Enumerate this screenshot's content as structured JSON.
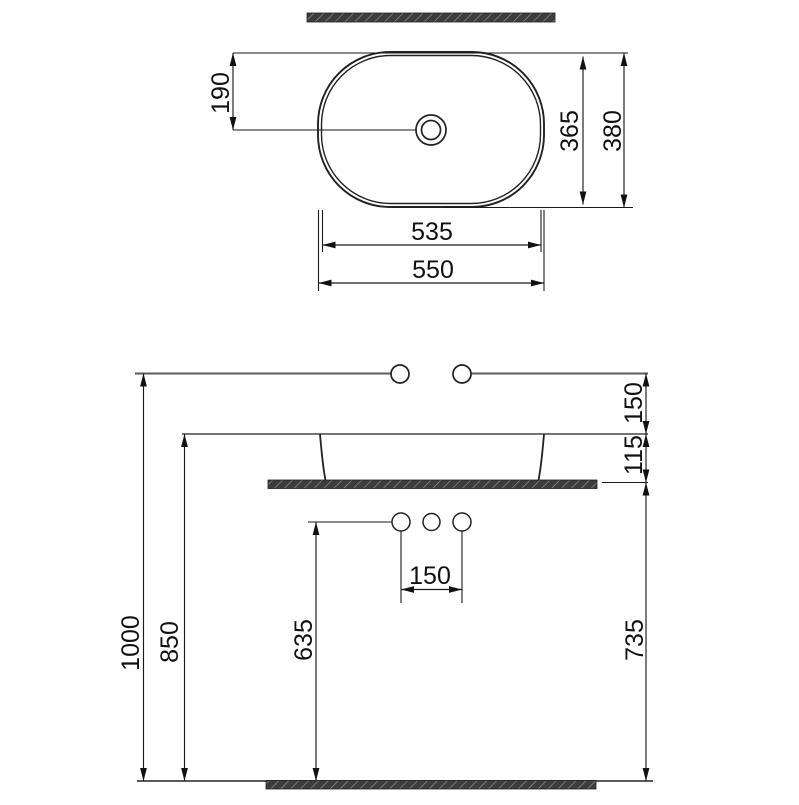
{
  "drawing": {
    "title": "washbasin-technical-drawing",
    "top_view": {
      "width_outer": "550",
      "width_inner": "535",
      "depth_outer": "380",
      "depth_inner": "365",
      "drain_from_back": "190"
    },
    "front_view": {
      "total_height": "1000",
      "rim_height": "850",
      "counter_height": "735",
      "drain_outlet_height": "635",
      "supply_above_rim": "150",
      "basin_above_counter": "115",
      "outlet_spacing": "150"
    },
    "colors": {
      "line": "#222222",
      "dim_line": "#1a1a1a",
      "wall_floor_line": "#5a5a5a",
      "hatch_fill": "#3d3d3d",
      "hatch_stroke": "#9c9c9c",
      "background": "#ffffff"
    }
  }
}
